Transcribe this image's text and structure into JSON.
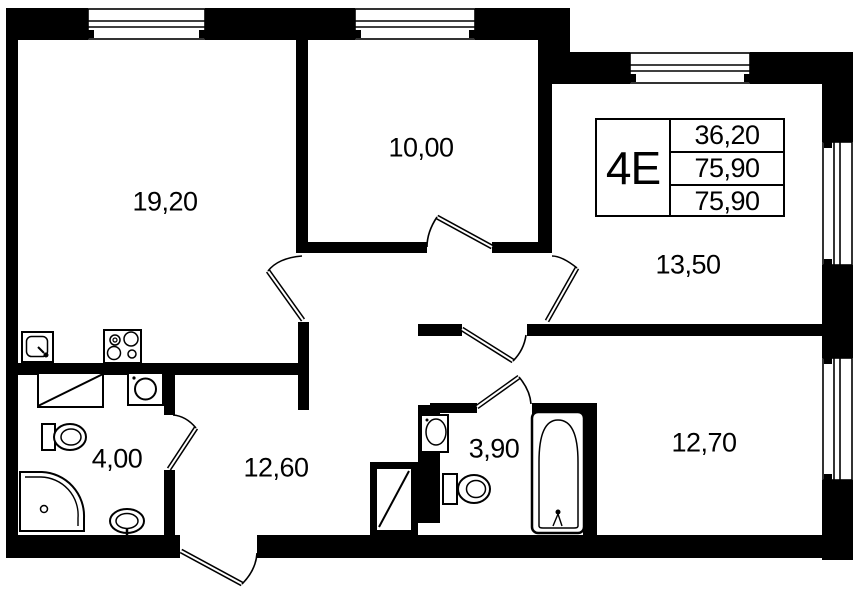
{
  "plan": {
    "title_block": {
      "unit_type": "4Е",
      "values": [
        "36,20",
        "75,90",
        "75,90"
      ]
    },
    "rooms": [
      {
        "name": "living-room",
        "area": "19,20"
      },
      {
        "name": "bedroom-small",
        "area": "10,00"
      },
      {
        "name": "bedroom-corner",
        "area": "13,50"
      },
      {
        "name": "bedroom-ensuite",
        "area": "12,70"
      },
      {
        "name": "hallway",
        "area": "12,60"
      },
      {
        "name": "bathroom-main",
        "area": "4,00"
      },
      {
        "name": "bathroom-ensuite",
        "area": "3,90"
      }
    ]
  }
}
